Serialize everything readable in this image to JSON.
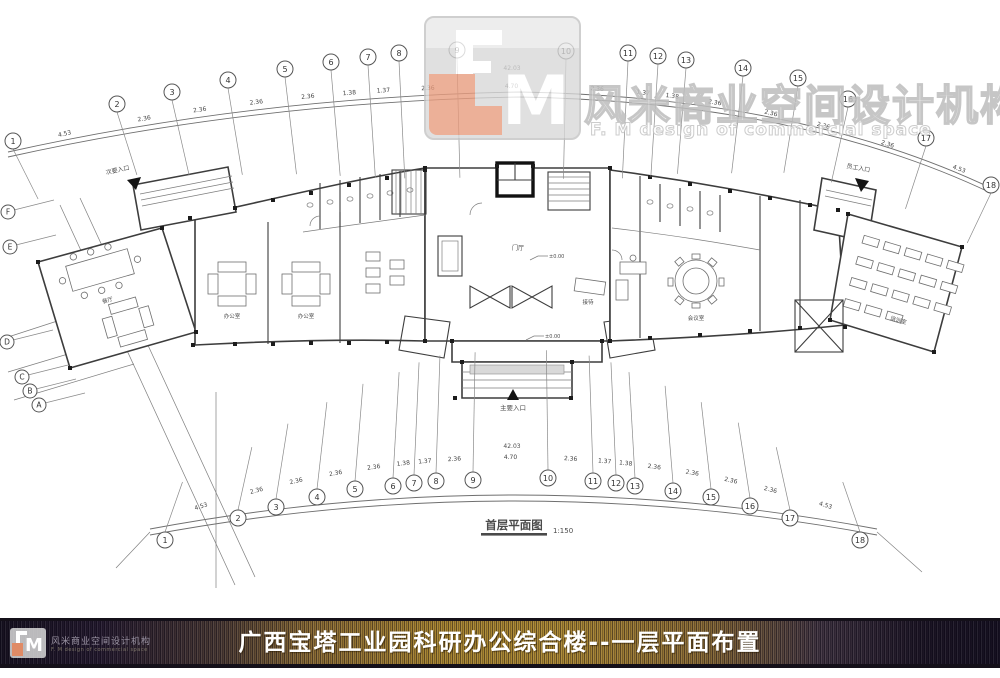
{
  "logo": {
    "monogram": "M",
    "cn": "风米商业空间设计机构",
    "en": "F. M design of commercial space"
  },
  "footer": {
    "title": "广西宝塔工业园科研办公综合楼--一层平面布置",
    "logo_cn": "风米商业空间设计机构",
    "logo_en": "F. M design of commercial space",
    "monogram": "M"
  },
  "drawing": {
    "title": "首层平面图",
    "scale": "1:150",
    "elevation": "±0.00",
    "entrances": {
      "left": "次要入口",
      "main": "主要入口",
      "right": "员工入口"
    },
    "room_labels": [
      "门厅",
      "办公室",
      "办公室",
      "会议室",
      "接待",
      "培训室",
      "餐厅"
    ]
  },
  "grid": {
    "top_numbers": [
      "1",
      "2",
      "3",
      "4",
      "5",
      "6",
      "7",
      "8",
      "9",
      "10",
      "11",
      "12",
      "13",
      "14",
      "15",
      "16",
      "17",
      "18"
    ],
    "bottom_numbers": [
      "1",
      "2",
      "3",
      "4",
      "5",
      "6",
      "7",
      "8",
      "9",
      "10",
      "11",
      "12",
      "13",
      "14",
      "15",
      "16",
      "17",
      "18"
    ],
    "left_letters": [
      "F",
      "E",
      "D",
      "C",
      "B",
      "A"
    ],
    "dims": [
      "4.53",
      "2.36",
      "2.36",
      "2.36",
      "2.36",
      "1.38",
      "1.37",
      "2.36",
      "4.70",
      "2.36",
      "1.37",
      "1.38",
      "2.36",
      "2.36",
      "2.36",
      "2.36",
      "4.53"
    ],
    "angle": "42.03"
  },
  "colors": {
    "accent_salmon": "#e89b7d",
    "logo_gray": "#d8d8d8",
    "gold": "#a7842e",
    "bar_dark": "#1c1524",
    "wall": "#3d3d3d"
  }
}
